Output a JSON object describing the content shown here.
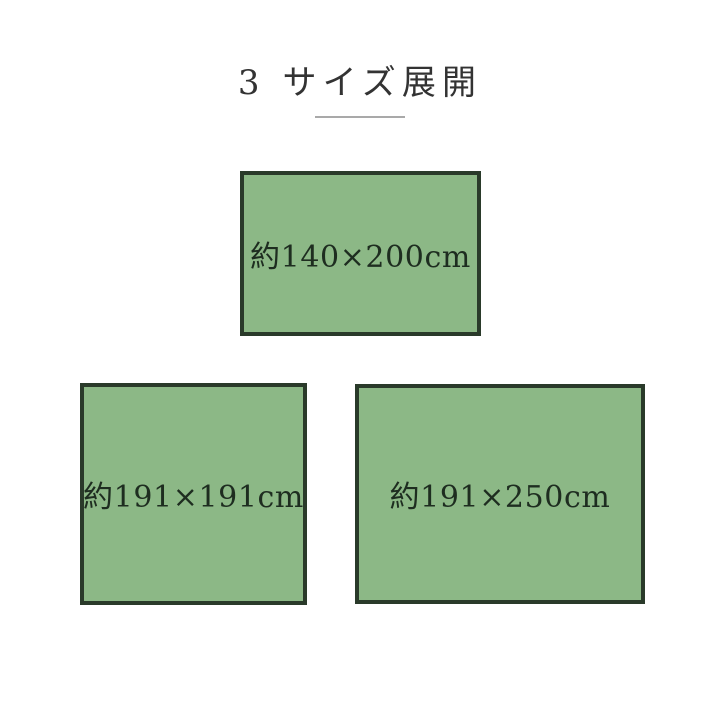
{
  "header": {
    "title": "3 サイズ展開"
  },
  "colors": {
    "background": "#ffffff",
    "rect_fill": "#8cb886",
    "rect_border": "#2a3a2a",
    "label_text": "#1e2d20",
    "title_text": "#333333",
    "divider": "#a9a9a9"
  },
  "sizes": [
    {
      "label": "約140×200cm",
      "width_cm": 140,
      "height_cm": 200
    },
    {
      "label": "約191×191cm",
      "width_cm": 191,
      "height_cm": 191
    },
    {
      "label": "約191×250cm",
      "width_cm": 191,
      "height_cm": 250
    }
  ]
}
